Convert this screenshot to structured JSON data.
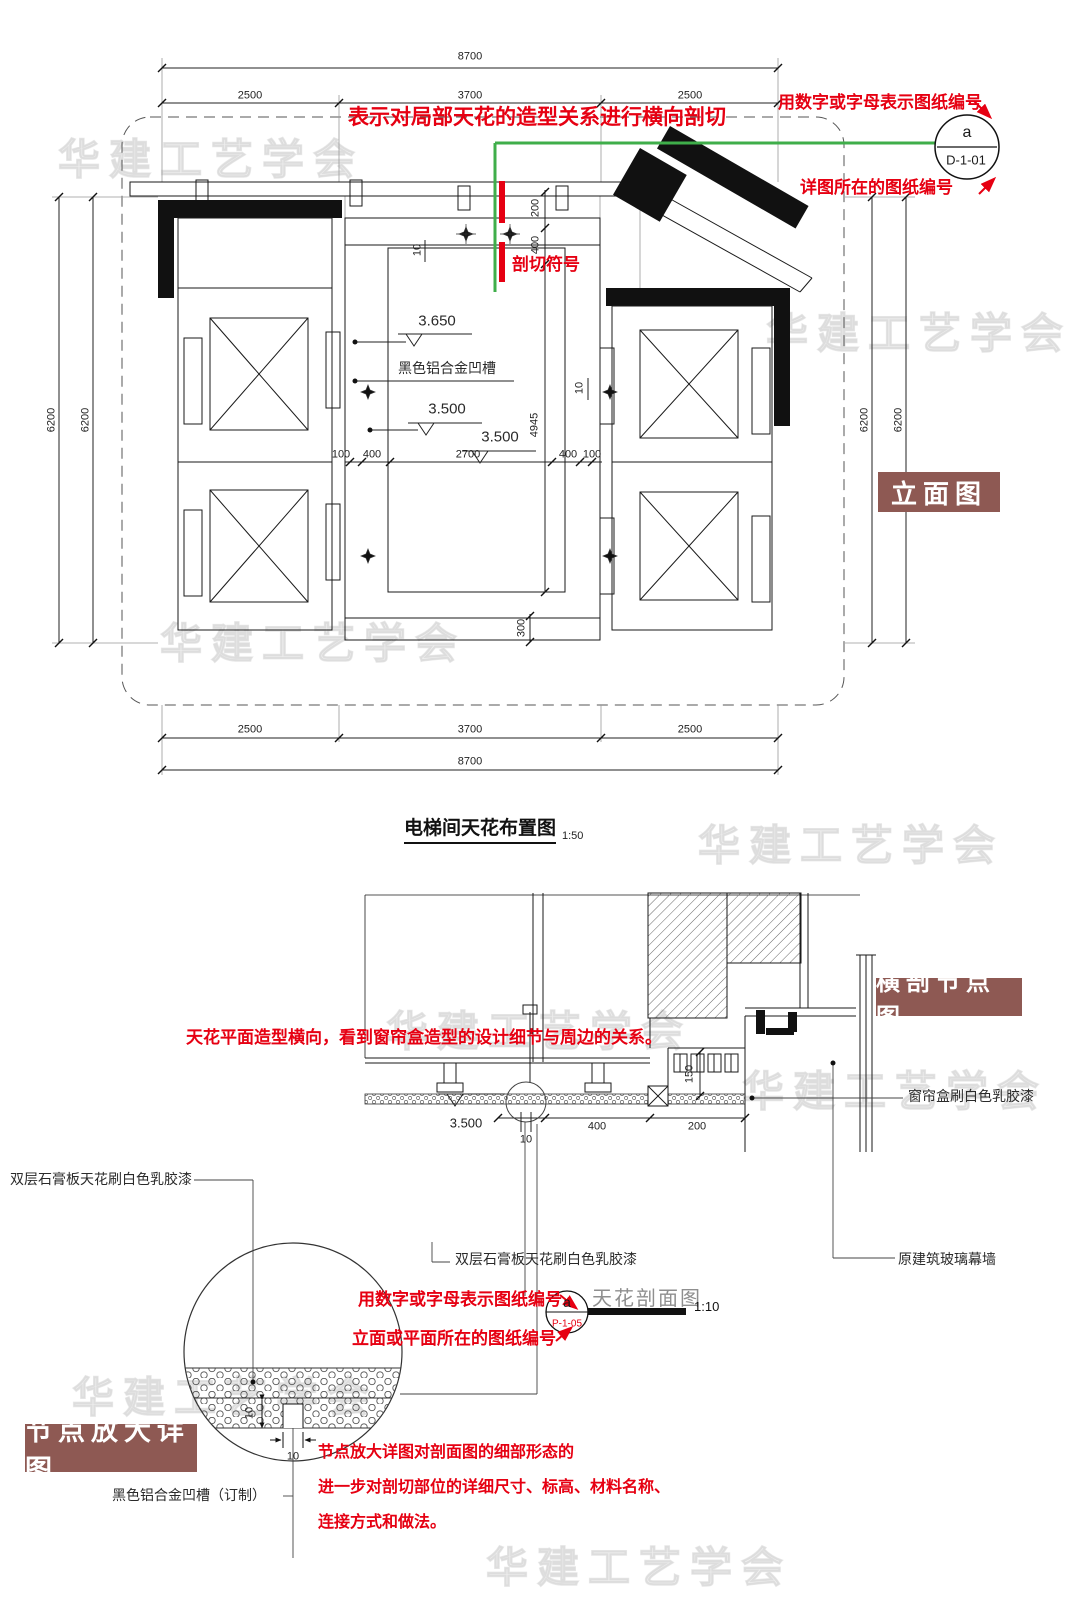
{
  "watermark": {
    "text": "华建工艺学会"
  },
  "colors": {
    "accent_red": "#e60012",
    "tag_bg": "#8e5953",
    "section_green": "#3fae4a"
  },
  "plan": {
    "title": "电梯间天花布置图",
    "scale": "1:50",
    "tag_elevation": "立面图",
    "notes": {
      "cut_direction": "表示对局部天花的造型关系进行横向剖切",
      "sheet_code": "用数字或字母表示图纸编号",
      "detail_sheet": "详图所在的图纸编号",
      "cut_symbol": "剖切符号"
    },
    "bubble": {
      "letter": "a",
      "sheet": "D-1-01"
    },
    "labels": {
      "groove": "黑色铝合金凹槽"
    },
    "levels": {
      "l1": "3.650",
      "l2": "3.500",
      "l3": "3.500"
    },
    "dims": {
      "total_top": "8700",
      "seg_left": "2500",
      "seg_mid": "3700",
      "seg_right": "2500",
      "total_bottom": "8700",
      "bseg_left": "2500",
      "bseg_mid": "3700",
      "bseg_right": "2500",
      "left_outer": "6200",
      "left_inner": "6200",
      "right_inner": "6200",
      "right_outer": "6200",
      "h100a": "100",
      "h400a": "400",
      "h2700": "2700",
      "h400b": "400",
      "h100b": "100",
      "v200": "200",
      "v400": "400",
      "v4945": "4945",
      "v300": "300",
      "t10a": "10",
      "t10b": "10"
    }
  },
  "section": {
    "tag": "横剖节点图",
    "note": "天花平面造型横向，看到窗帘盒造型的设计细节与周边的关系。",
    "labels": {
      "curtain_box": "窗帘盒刷白色乳胶漆",
      "gypsum_left": "双层石膏板天花刷白色乳胶漆",
      "gypsum_center": "双层石膏板天花刷白色乳胶漆",
      "glass_wall": "原建筑玻璃幕墙"
    },
    "dims": {
      "level": "3.500",
      "d10": "10",
      "d400": "400",
      "d200": "200",
      "d150": "150"
    },
    "caption": {
      "title": "天花剖面图",
      "scale": "1:10"
    },
    "bubble": {
      "letter": "a",
      "sheet": "P-1-05"
    },
    "notes": {
      "sheet_code": "用数字或字母表示图纸编号",
      "where": "立面或平面所在的图纸编号"
    }
  },
  "detail": {
    "tag": "节点放大详图",
    "label_groove": "黑色铝合金凹槽（订制）",
    "dims": {
      "d10v": "10",
      "d10h": "10"
    },
    "note_line1": "节点放大详图对剖面图的细部形态的",
    "note_line2": "进一步对剖切部位的详细尺寸、标高、材料名称、",
    "note_line3": "连接方式和做法。"
  }
}
